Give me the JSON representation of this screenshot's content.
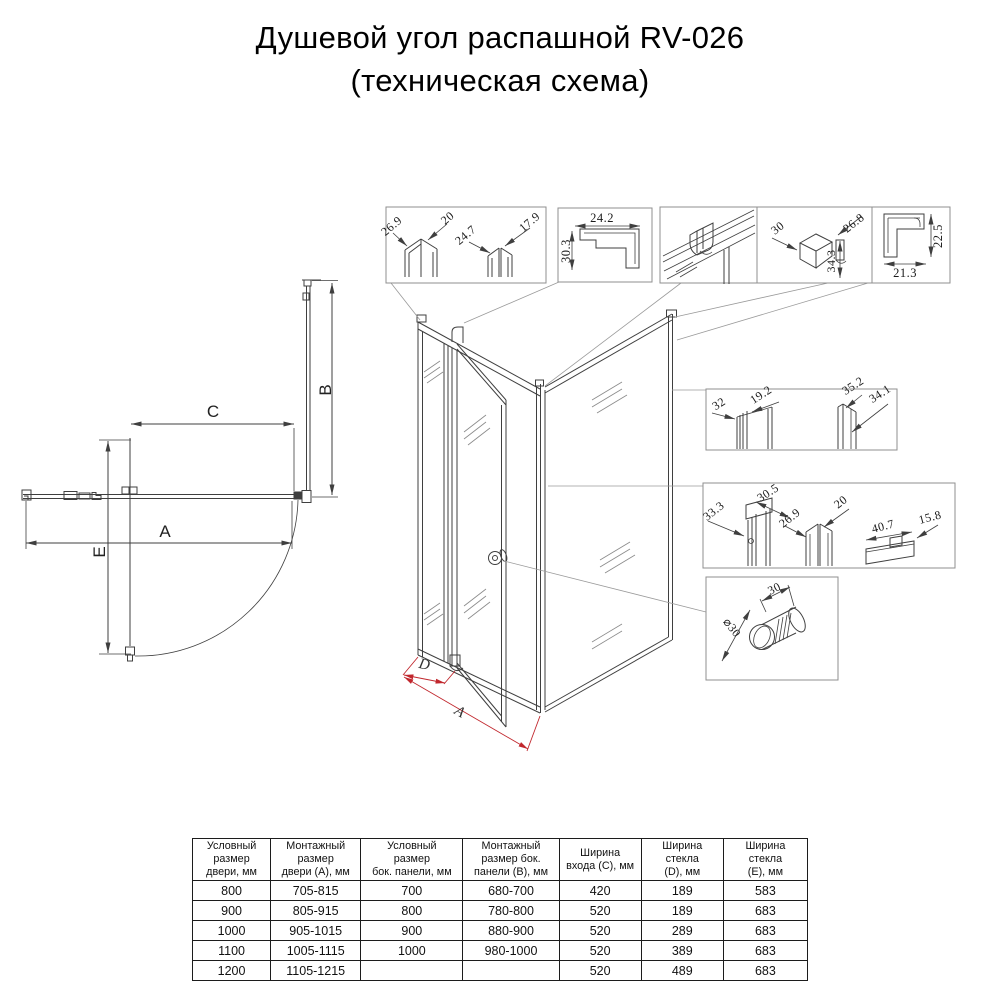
{
  "title": {
    "line1": "Душевой угол распашной RV-026",
    "line2": "(техническая схема)"
  },
  "plan_labels": {
    "a": "A",
    "b": "B",
    "c": "C",
    "e": "E"
  },
  "iso_labels": {
    "a": "A",
    "d": "D"
  },
  "details": {
    "glass_profiles": {
      "d1": "26.9",
      "d2": "20",
      "d3": "24.7",
      "d4": "17.9"
    },
    "corner_profile": {
      "w": "24.2",
      "h": "30.3"
    },
    "corner_bracket": {
      "d1": "30",
      "d2": "26.8",
      "d3": "34.3"
    },
    "l_profile": {
      "h": "22.5",
      "w": "21.3"
    },
    "door_jamb": {
      "d1": "32",
      "d2": "19.2",
      "d3": "35.2",
      "d4": "34.1"
    },
    "wall_profile": {
      "d1": "33.3",
      "d2": "30.5",
      "d3": "26.9",
      "d4": "20",
      "d5": "40.7",
      "d6": "15.8"
    },
    "knob": {
      "len": "30",
      "dia": "⌀30"
    }
  },
  "colors": {
    "line": "#3f3f3f",
    "box": "#8f8f8f",
    "dim_red": "#c1272d",
    "text": "#111111"
  },
  "table": {
    "headers": [
      "Условный\nразмер\nдвери, мм",
      "Монтажный\nразмер\nдвери (A), мм",
      "Условный\nразмер\nбок. панели, мм",
      "Монтажный\nразмер бок.\nпанели (B), мм",
      "Ширина\nвхода (C), мм",
      "Ширина\nстекла\n(D), мм",
      "Ширина\nстекла\n(E), мм"
    ],
    "rows": [
      [
        "800",
        "705-815",
        "700",
        "680-700",
        "420",
        "189",
        "583"
      ],
      [
        "900",
        "805-915",
        "800",
        "780-800",
        "520",
        "189",
        "683"
      ],
      [
        "1000",
        "905-1015",
        "900",
        "880-900",
        "520",
        "289",
        "683"
      ],
      [
        "1100",
        "1005-1115",
        "1000",
        "980-1000",
        "520",
        "389",
        "683"
      ],
      [
        "1200",
        "1105-1215",
        "",
        "",
        "520",
        "489",
        "683"
      ]
    ]
  }
}
